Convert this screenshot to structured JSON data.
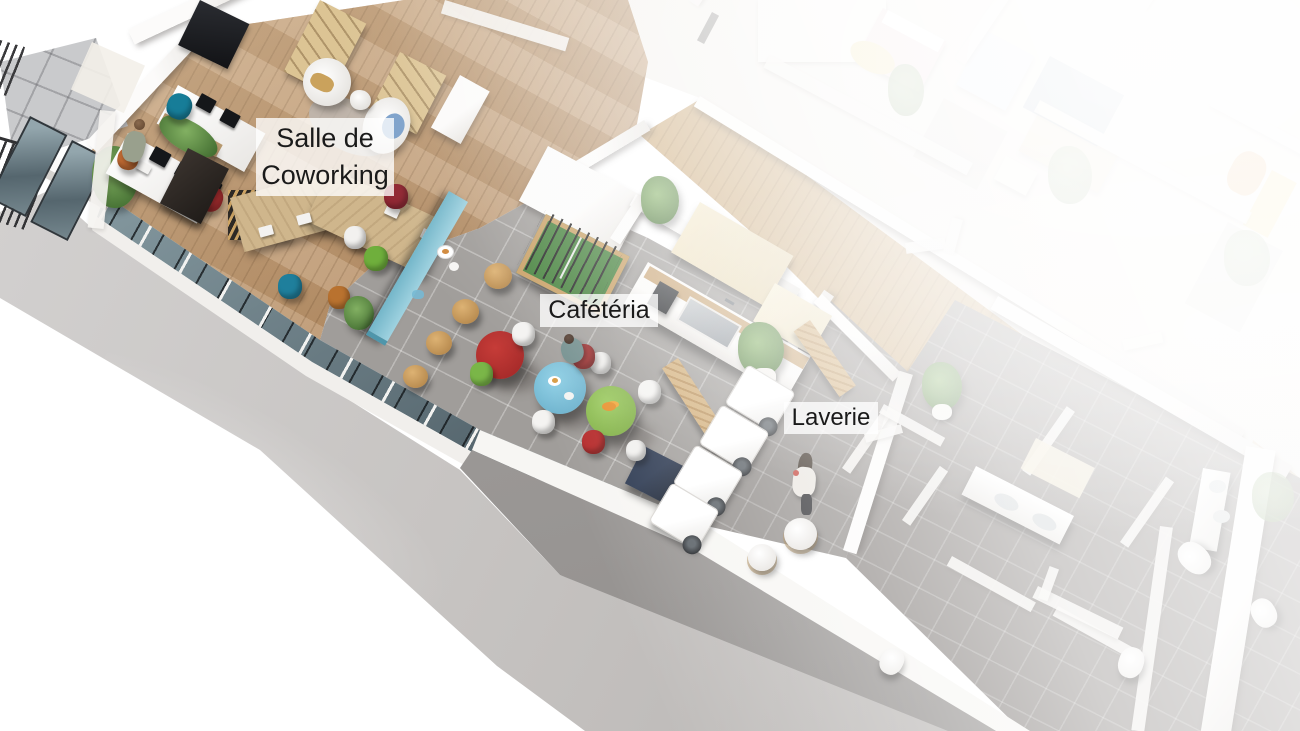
{
  "scene": {
    "title": "3D cutaway floor plan rendering",
    "labels": {
      "coworking": {
        "line1": "Salle de",
        "line2": "Coworking"
      },
      "cafeteria": {
        "line1": "Cafétéria"
      },
      "laundry": {
        "line1": "Laverie"
      }
    },
    "rooms": [
      {
        "id": "coworking",
        "name": "Salle de Coworking",
        "floor": "wood"
      },
      {
        "id": "cafeteria",
        "name": "Cafétéria",
        "floor": "gray tile"
      },
      {
        "id": "laundry",
        "name": "Laverie",
        "floor": "gray tile"
      },
      {
        "id": "bathrooms",
        "name": "Sanitaires",
        "floor": "dark gray tile"
      },
      {
        "id": "balcony",
        "name": "Balcon",
        "floor": "light gray tile"
      },
      {
        "id": "corridor",
        "name": "Couloir",
        "floor": "wood"
      }
    ],
    "palette": {
      "wood_floor": "#b9926a",
      "cafeteria_tile": "#a09d9a",
      "bathroom_tile": "#8b8683",
      "concrete": "#c6c3c1",
      "wall_white": "#f7f5f2",
      "counter_blue": "#8ec9da",
      "table_red": "#b12f2f",
      "table_blue": "#7cc0da",
      "table_green": "#8cbf54",
      "foosball_green": "#3e7d35",
      "label_bg": "rgba(255,255,255,0.78)",
      "label_text": "#1a1a1a"
    }
  }
}
